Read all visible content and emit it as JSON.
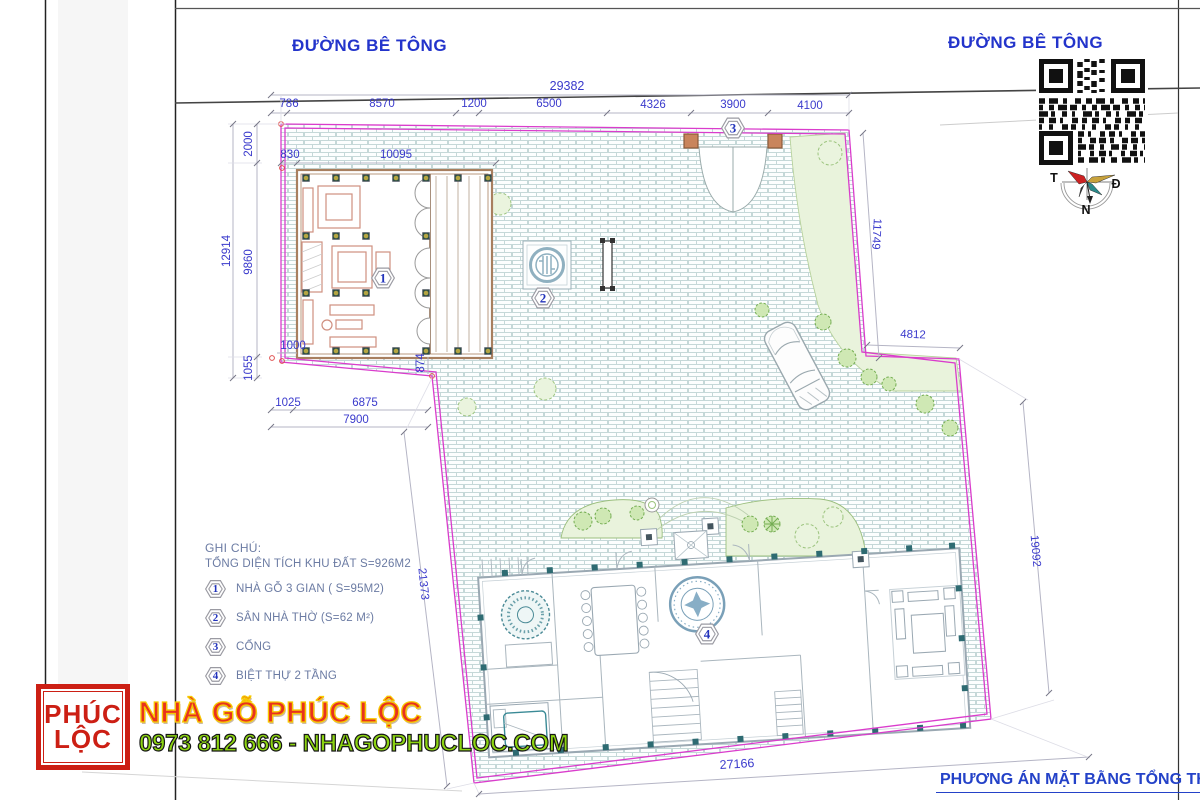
{
  "roads": {
    "left": "ĐƯỜNG BÊ TÔNG",
    "right": "ĐƯỜNG BÊ TÔNG"
  },
  "compass": {
    "west": "T",
    "east": "Đ",
    "south": "N"
  },
  "dims": {
    "top_total": "29382",
    "top_segments": [
      "786",
      "8570",
      "1200",
      "6500",
      "4326",
      "3900",
      "4100"
    ],
    "left_outer": "12914",
    "left_top": "2000",
    "left_mid": "9860",
    "left_bottom": "1055",
    "house_offset": "830",
    "house_width": "10095",
    "house_south_offset": "1000",
    "veranda": "874",
    "below_left": "1025",
    "below_mid": "6875",
    "below_total": "7900",
    "right_upper": "11749",
    "right_step": "4812",
    "right_lower": "19092",
    "west_diag": "21373",
    "south_edge": "27166"
  },
  "markers": {
    "m1": "1",
    "m2": "2",
    "m3": "3",
    "m4": "4"
  },
  "legend": {
    "title": "GHI CHÚ:",
    "subtitle": "TỔNG DIỆN TÍCH KHU ĐẤT S=926M2",
    "items": [
      {
        "num": "1",
        "label": "NHÀ GỖ 3 GIAN ( S=95M2)"
      },
      {
        "num": "2",
        "label": "SÂN NHÀ THỜ (S=62 M²)"
      },
      {
        "num": "3",
        "label": "CỔNG"
      },
      {
        "num": "4",
        "label": "BIỆT THỰ 2 TẦNG"
      }
    ]
  },
  "banner": {
    "logo_line1": "PHÚC",
    "logo_line2": "LỘC",
    "title": "NHÀ GỖ PHÚC LỘC",
    "contact": "0973 812 666 - NHAGOPHUCLOC.COM"
  },
  "footer": {
    "plan_title": "PHƯƠNG ÁN MẶT BẰNG TỔNG THỂ"
  },
  "colors": {
    "boundary_pink": "#da3ccc",
    "dimension_blue": "#3a3acc",
    "brick_line": "#c5d8d8",
    "banner_title_red": "#e8321e",
    "banner_contact_green": "#8cd411",
    "legend_text": "#6b7ba3",
    "column_teal": "#2e6b72",
    "furniture_salmon": "#cf8f7f"
  }
}
